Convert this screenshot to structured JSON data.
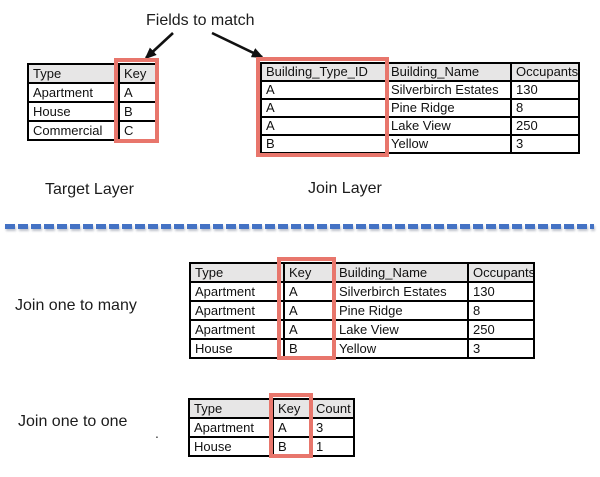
{
  "labels": {
    "fields_to_match": "Fields to match",
    "target_layer": "Target Layer",
    "join_layer": "Join Layer",
    "join_one_to_many": "Join one to many",
    "join_one_to_one": "Join one to one",
    "stray_period": "."
  },
  "colors": {
    "highlight_red": "#E8766C",
    "dash_blue": "#4472C4",
    "header_fill": "#E7E6E6",
    "table_border": "#000000",
    "arrow_black": "#111111"
  },
  "tables": {
    "target": {
      "headers": [
        "Type",
        "Key"
      ],
      "rows": [
        [
          "Apartment",
          "A"
        ],
        [
          "House",
          "B"
        ],
        [
          "Commercial",
          "C"
        ]
      ],
      "highlighted_column": "Key"
    },
    "join": {
      "headers": [
        "Building_Type_ID",
        "Building_Name",
        "Occupants"
      ],
      "rows": [
        [
          "A",
          "Silverbirch Estates",
          "130"
        ],
        [
          "A",
          "Pine Ridge",
          "8"
        ],
        [
          "A",
          "Lake View",
          "250"
        ],
        [
          "B",
          "Yellow",
          "3"
        ]
      ],
      "highlighted_column": "Building_Type_ID"
    },
    "one_to_many": {
      "headers": [
        "Type",
        "Key",
        "Building_Name",
        "Occupants"
      ],
      "rows": [
        [
          "Apartment",
          "A",
          "Silverbirch Estates",
          "130"
        ],
        [
          "Apartment",
          "A",
          "Pine Ridge",
          "8"
        ],
        [
          "Apartment",
          "A",
          "Lake View",
          "250"
        ],
        [
          "House",
          "B",
          "Yellow",
          "3"
        ]
      ],
      "highlighted_column": "Key"
    },
    "one_to_one": {
      "headers": [
        "Type",
        "Key",
        "Count"
      ],
      "rows": [
        [
          "Apartment",
          "A",
          "3"
        ],
        [
          "House",
          "B",
          "1"
        ]
      ],
      "highlighted_column": "Key"
    }
  }
}
